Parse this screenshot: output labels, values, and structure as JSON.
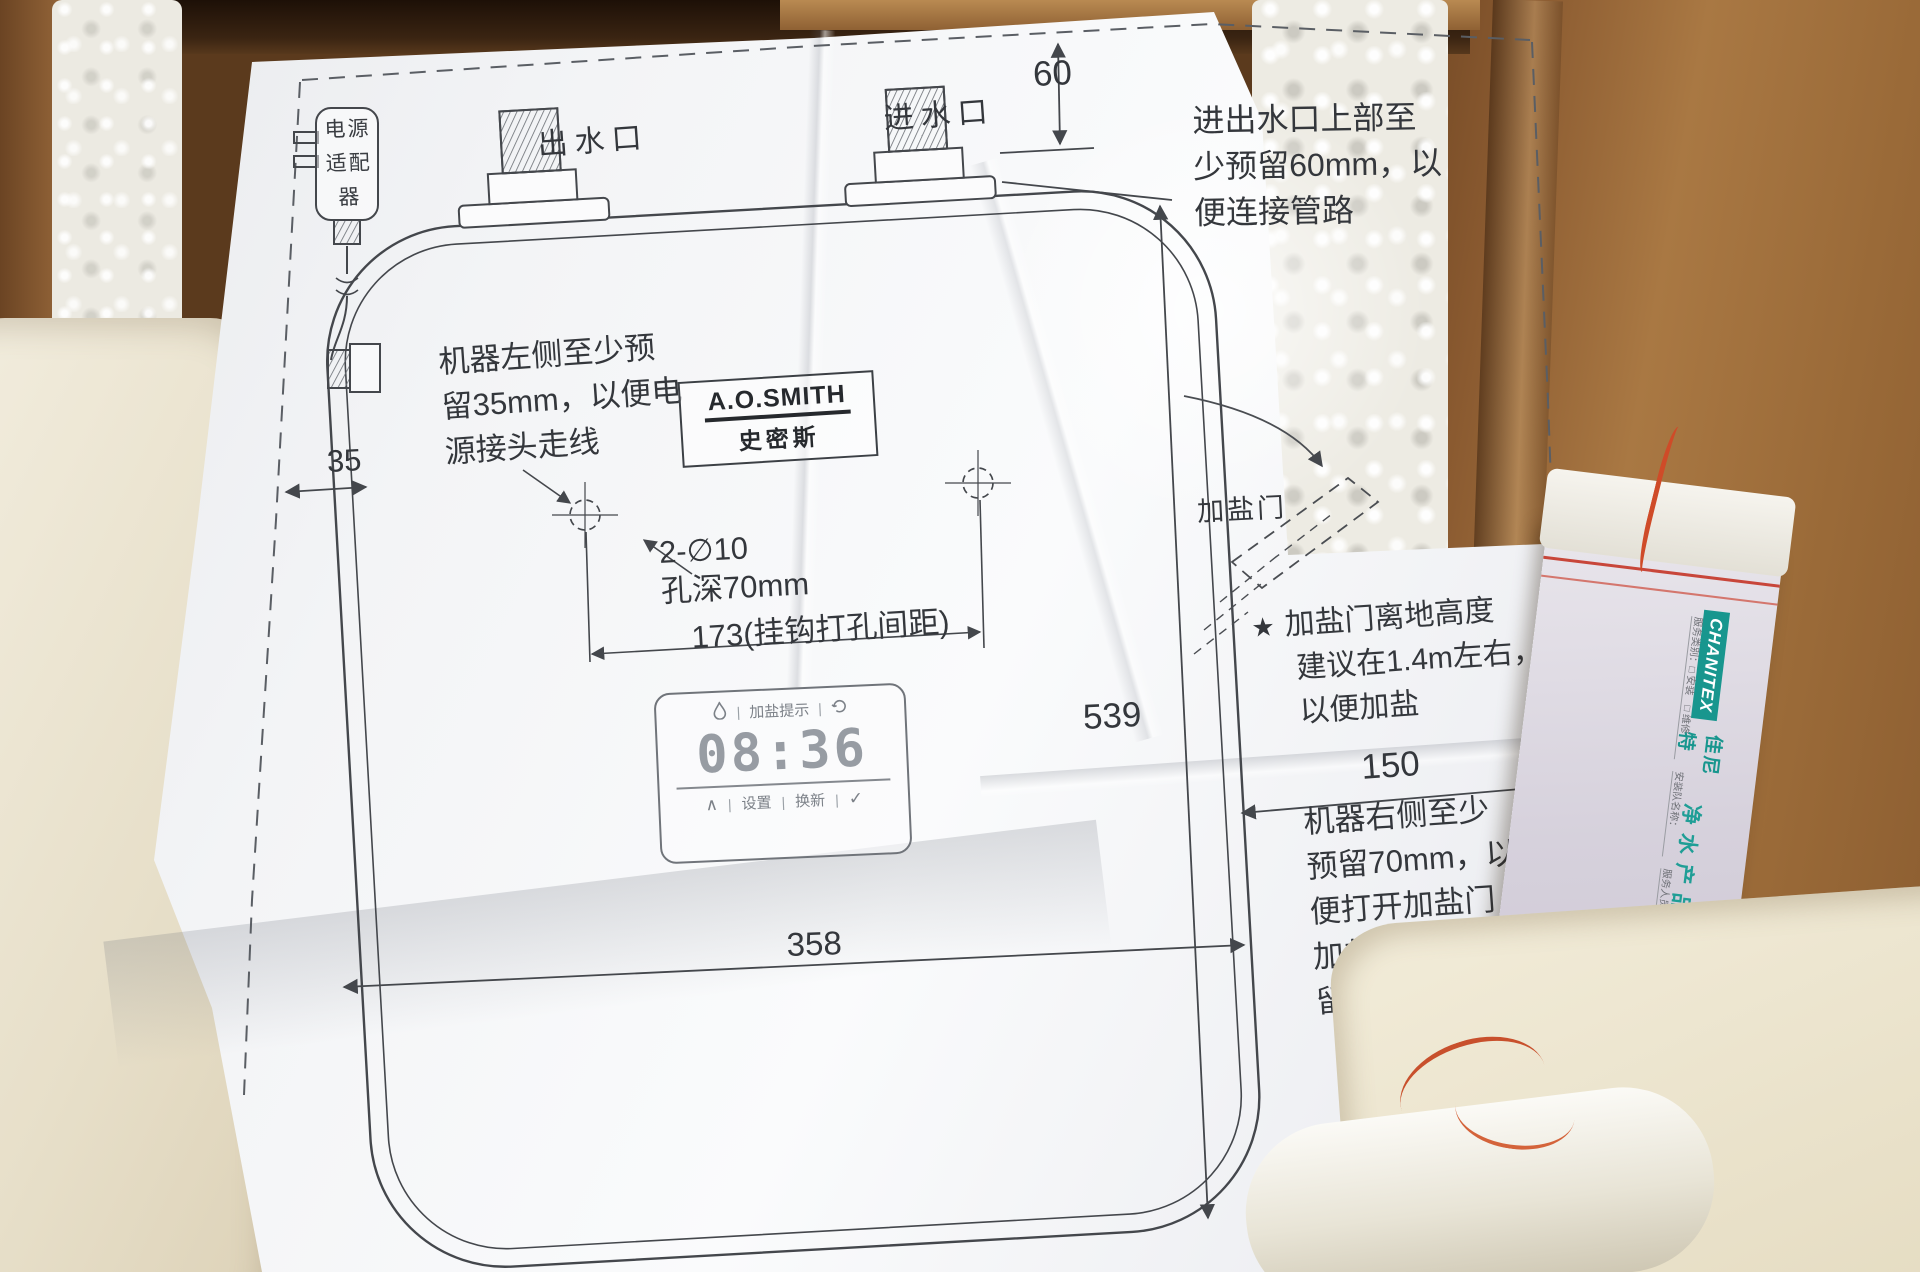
{
  "diagram": {
    "port_labels": {
      "outlet": "出水口",
      "inlet": "进水口"
    },
    "adapter_label_lines": [
      "电源",
      "适配",
      "器"
    ],
    "dimensions": {
      "top_clearance": "60",
      "left_clearance": "35",
      "hook_spacing": "173(挂钩打孔间距)",
      "height": "539",
      "width": "358",
      "right_clearance": "150"
    },
    "hole_note": {
      "line1": "2-∅10",
      "line2": "孔深70mm"
    },
    "salt_door_label": "加盐门",
    "notes": {
      "top_right": [
        "进出水口上部至",
        "少预留60mm，以",
        "便连接管路"
      ],
      "left": [
        "机器左侧至少预",
        "留35mm，以便电",
        "源接头走线"
      ],
      "star_marker": "★",
      "star": [
        "加盐门离地高度",
        "建议在1.4m左右，",
        "以便加盐"
      ],
      "right": [
        "机器右侧至少",
        "预留70mm，以",
        "便打开加盐门",
        "加盐，最优预",
        "留150mm"
      ]
    },
    "logo": {
      "brand": "A.O.SMITH",
      "brand_cn": "史密斯"
    },
    "display": {
      "alert_label": "加盐提示",
      "time": "08:36",
      "separator": "|",
      "up_arrow": "∧",
      "check": "✓",
      "button_set": "设置",
      "button_renew": "换新"
    }
  },
  "pamphlet": {
    "brand_en": "CHANITEX",
    "brand_cn": "佳尼特",
    "title": "净水产品安装工单",
    "serial_no": "NO.CEP-00081933",
    "fields": [
      "服务类别：□ 安装　□ 维修",
      "安装队名称：",
      "服务人员：",
      "施工单号："
    ]
  },
  "colors": {
    "paper": "#f6f7f9",
    "cardboard": "#9a6a3c",
    "foam": "#ece5d3",
    "print_line": "#44474c",
    "brand_teal": "#18968e",
    "serial_red": "#c03a2d"
  }
}
